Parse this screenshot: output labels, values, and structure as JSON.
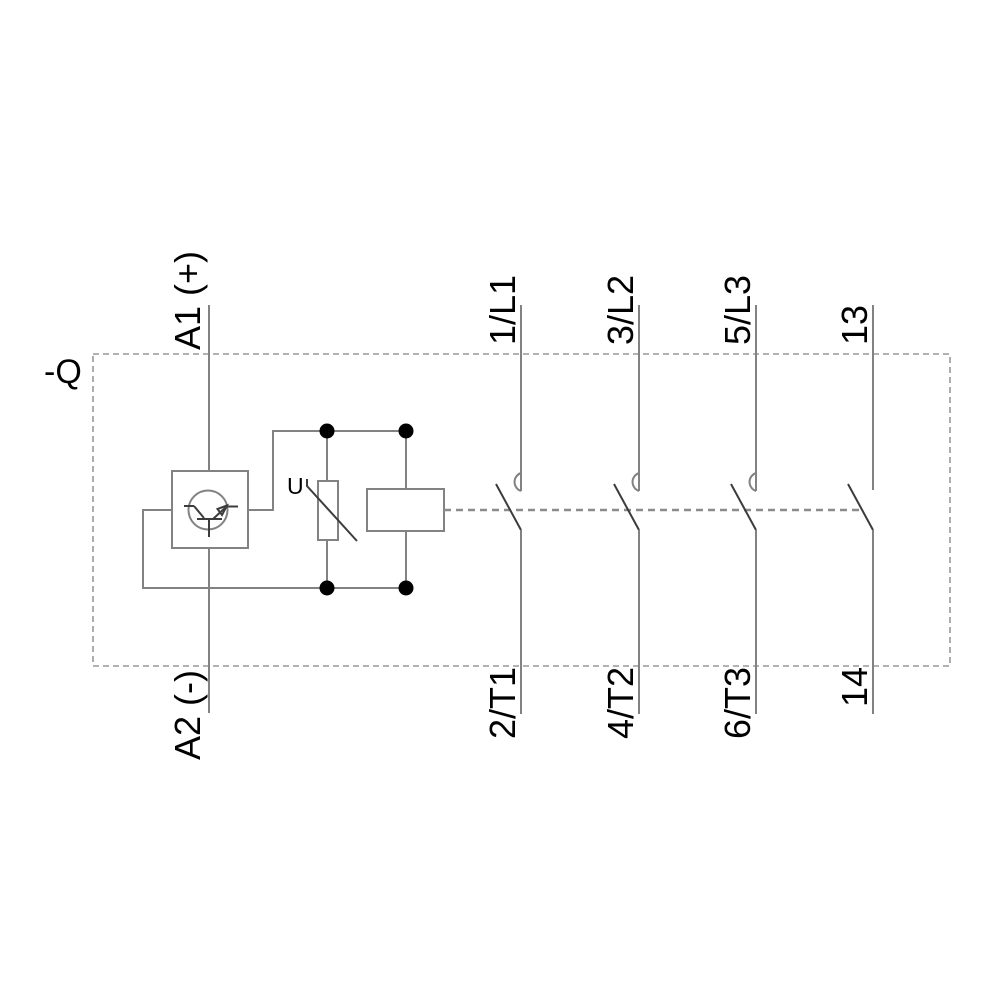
{
  "diagram": {
    "type": "contactor-schematic",
    "device_reference": "-Q",
    "coil_circuit": {
      "terminal_top": "A1 (+)",
      "terminal_bottom": "A2 (-)",
      "varistor_label": "U"
    },
    "main_poles": [
      {
        "terminal_top": "1/L1",
        "terminal_bottom": "2/T1"
      },
      {
        "terminal_top": "3/L2",
        "terminal_bottom": "4/T2"
      },
      {
        "terminal_top": "5/L3",
        "terminal_bottom": "6/T3"
      }
    ],
    "auxiliary_contact": {
      "terminal_top": "13",
      "terminal_bottom": "14"
    },
    "colors": {
      "background": "#ffffff",
      "wire": "#828282",
      "contact_blade": "#3c3c3c",
      "junction_dot": "#000000",
      "boundary_dash": "#999999",
      "label_text": "#000000"
    }
  }
}
